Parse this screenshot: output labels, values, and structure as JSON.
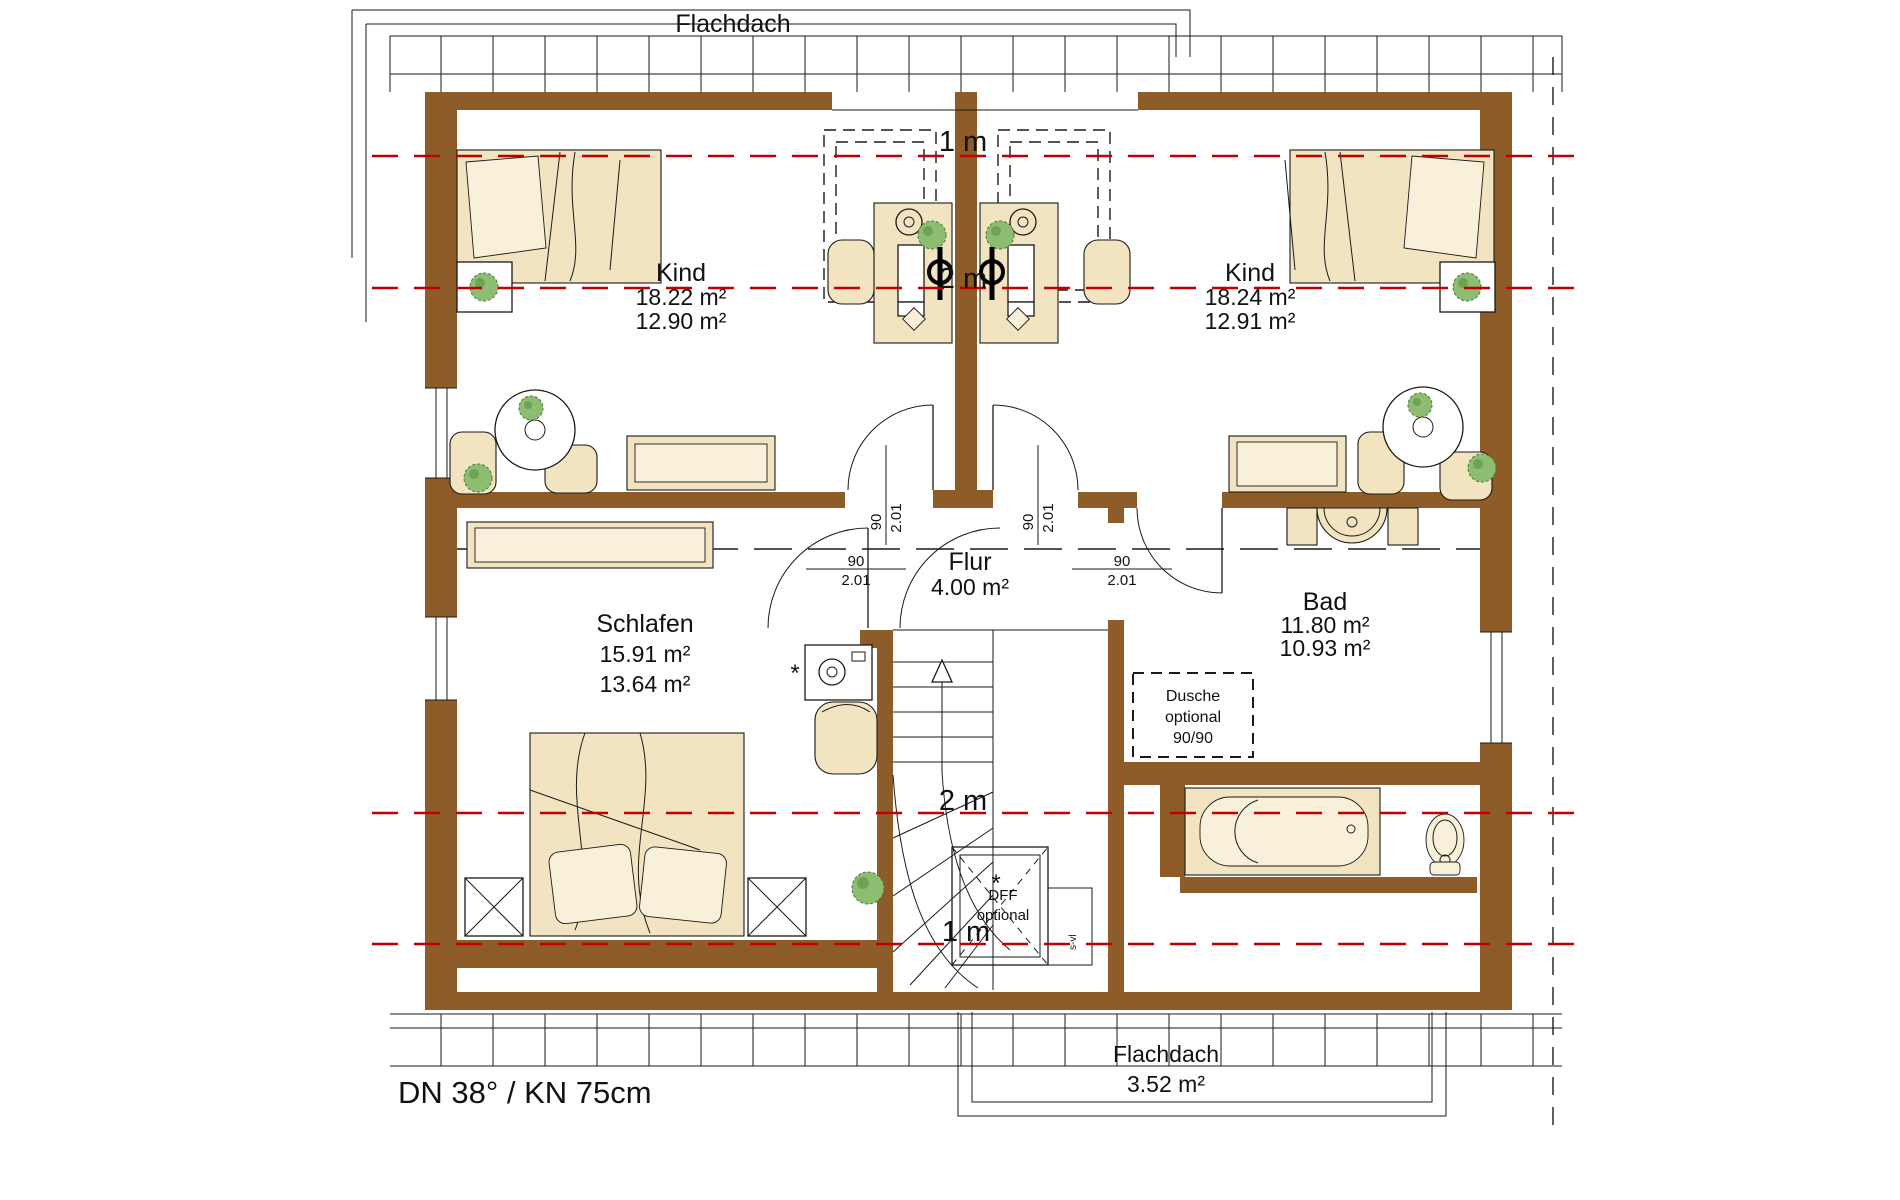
{
  "drawing": {
    "roof_label_top": "Flachdach",
    "roof_spec": "DN 38° / KN 75cm",
    "flat_roof_bottom": {
      "name": "Flachdach",
      "area": "3.52 m²"
    }
  },
  "rooms": {
    "kind_left": {
      "name": "Kind",
      "area_gross": "18.22 m²",
      "area_net": "12.90 m²"
    },
    "kind_right": {
      "name": "Kind",
      "area_gross": "18.24 m²",
      "area_net": "12.91 m²"
    },
    "flur": {
      "name": "Flur",
      "area": "4.00 m²"
    },
    "schlafen": {
      "name": "Schlafen",
      "area_gross": "15.91 m²",
      "area_net": "13.64 m²"
    },
    "bad": {
      "name": "Bad",
      "area_gross": "11.80 m²",
      "area_net": "10.93 m²"
    }
  },
  "height_lines": {
    "one_m_top": "1 m",
    "two_m_top": "2 m",
    "two_m_bottom": "2 m",
    "one_m_bottom": "1 m"
  },
  "door_label": {
    "width": "90",
    "height": "2.01"
  },
  "shower": {
    "line1": "Dusche",
    "line2": "optional",
    "line3": "90/90"
  },
  "roof_window": {
    "line1": "DFF",
    "line2": "optional",
    "asterisk": "*"
  },
  "stair": {
    "side_label": "s-vl"
  },
  "colors": {
    "wall": "#8d5c28",
    "annotation_red": "#c00000",
    "furniture_beige": "#f2e4c0",
    "furniture_light": "#f9f0da",
    "plant_green": "#8cbd70",
    "line_black": "#1a1a1a"
  }
}
